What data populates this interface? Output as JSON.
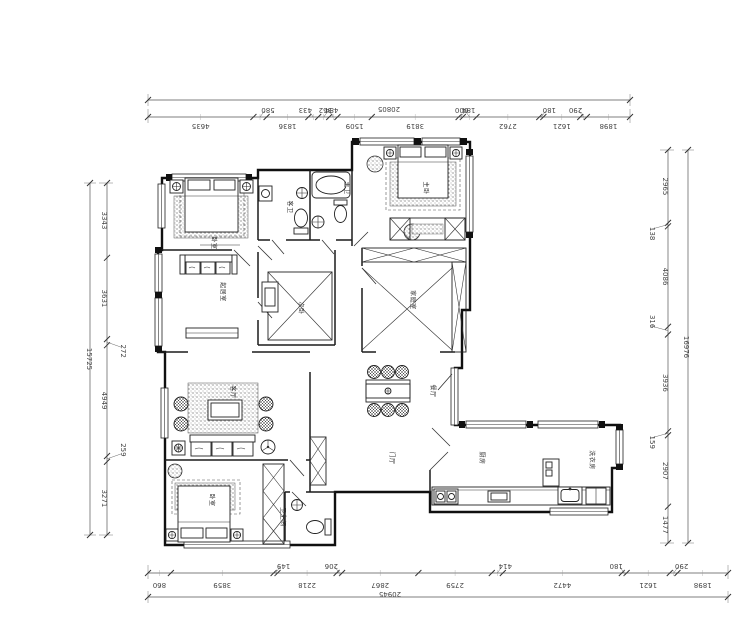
{
  "dims": {
    "top": {
      "overall": "20805",
      "segments": [
        "4635",
        "580",
        "1836",
        "433",
        "484",
        "362",
        "1509",
        "3819",
        "184",
        "600",
        "2762",
        "180",
        "1621",
        "290",
        "1898"
      ]
    },
    "bottom": {
      "overall": "20945",
      "segments": [
        "860",
        "3859",
        "149",
        "2218",
        "206",
        "2867",
        "2759",
        "414",
        "4472",
        "180",
        "1621",
        "290",
        "1898"
      ]
    },
    "left": {
      "overall": "15725",
      "segments": [
        "3343",
        "3631",
        "272",
        "4949",
        "259",
        "3271"
      ]
    },
    "right": {
      "overall": "16976",
      "segments": [
        "2965",
        "138",
        "4086",
        "316",
        "3936",
        "159",
        "2907",
        "1477"
      ]
    }
  },
  "rooms": {
    "bedroom_tl": "卧室",
    "sitting": "起居室",
    "bedroom_small": "次卧",
    "bath_guest": "客卫",
    "bath_master": "主卫",
    "bedroom_master": "主卧",
    "family": "家庭室",
    "living": "客厅",
    "dining": "餐厅",
    "bedroom_bl": "卧室",
    "bath_bl": "卫生间",
    "hall": "门厅",
    "kitchen": "厨房",
    "utility": "洗衣房"
  },
  "colors": {
    "line": "#1a1a1a",
    "dim": "#555555",
    "hatch": "#666666"
  }
}
